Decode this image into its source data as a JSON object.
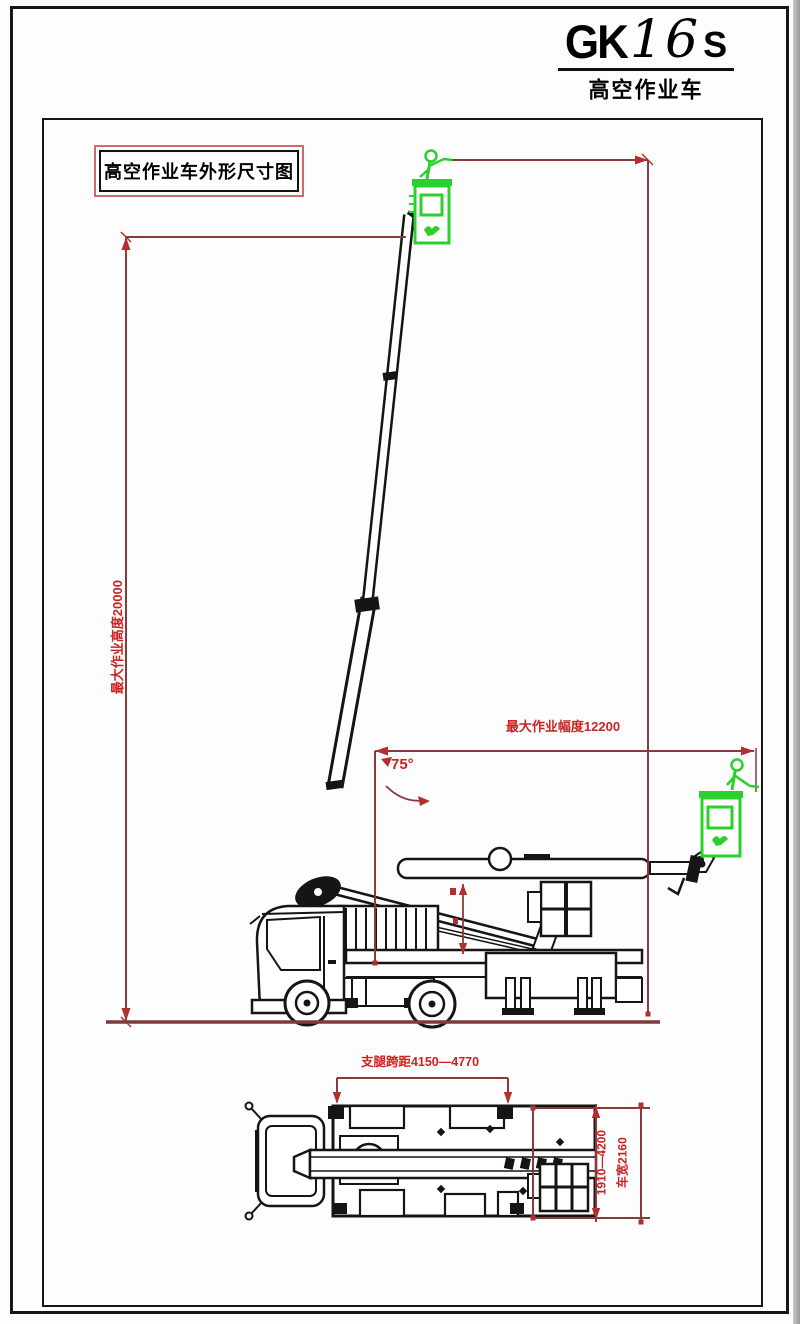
{
  "header": {
    "brand_gk": "GK",
    "brand_num": "16",
    "brand_s": "S",
    "subtitle": "高空作业车"
  },
  "drawing": {
    "title": "高空作业车外形尺寸图",
    "angle_label": "75°",
    "dims": {
      "max_working_height": "最大作业高度20000",
      "max_working_radius": "最大作业幅度12200",
      "outrigger_span": "支腿跨距4150—4770",
      "outrigger_lateral_range": "1910—4200",
      "vehicle_width": "车宽2160"
    }
  },
  "icons": {
    "operator": "operator-icon (stick figure in basket)",
    "basket_logo": "basket-logo-icon (green emblem on basket)"
  },
  "colors": {
    "dimension_line": "#8a3a3a",
    "dimension_accent": "#b03030",
    "dimension_text": "#cc2222",
    "ground_line": "#7d3b3b",
    "drawing_line": "#151515",
    "green": "#2bd12b",
    "title_box_border": "#cc6b6b"
  }
}
